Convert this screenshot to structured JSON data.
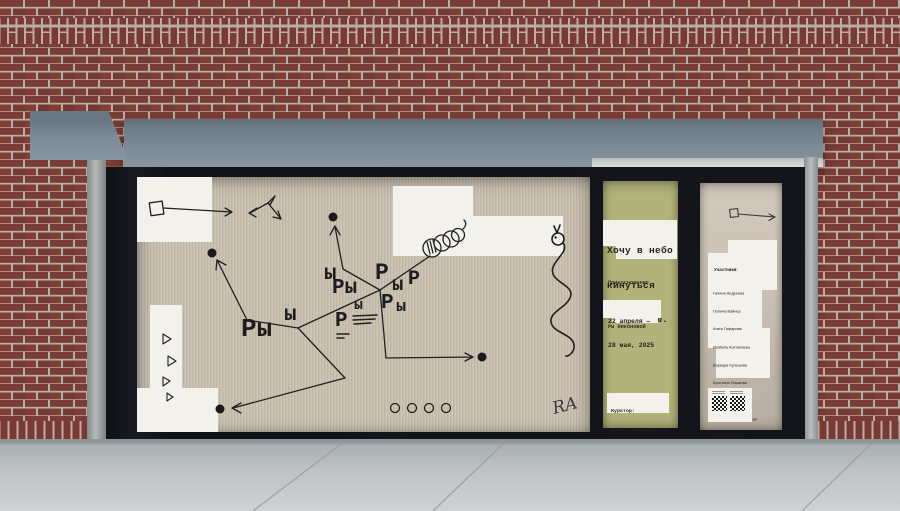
{
  "window_main": {
    "letters": [
      {
        "t": "ы",
        "x": 187,
        "y": 87,
        "s": 21
      },
      {
        "t": "Ры",
        "x": 195,
        "y": 101,
        "s": 21
      },
      {
        "t": "Р",
        "x": 238,
        "y": 85,
        "s": 23
      },
      {
        "t": "ы",
        "x": 255,
        "y": 99,
        "s": 19
      },
      {
        "t": "Р",
        "x": 271,
        "y": 93,
        "s": 20
      },
      {
        "t": "ы",
        "x": 217,
        "y": 121,
        "s": 15
      },
      {
        "t": "Р",
        "x": 244,
        "y": 116,
        "s": 21
      },
      {
        "t": "ы",
        "x": 259,
        "y": 122,
        "s": 17
      },
      {
        "t": "Р",
        "x": 198,
        "y": 134,
        "s": 21
      },
      {
        "t": "ы",
        "x": 147,
        "y": 128,
        "s": 21
      },
      {
        "t": "Ры",
        "x": 104,
        "y": 139,
        "s": 26
      }
    ],
    "signature": "RA"
  },
  "window_left_panel": {
    "title_lines": [
      "Хочу в небо",
      "кинуться",
      "собакою."
    ],
    "subtitle_lines": [
      "Прикосновение",
      "к архиву",
      "Ры Никоновой"
    ],
    "date_lines": [
      "22 апреля —",
      "28 мая, 2025"
    ],
    "curator_lines": [
      "Куратор:",
      "Алёна Герасимчук"
    ]
  },
  "window_right_panel": {
    "participants_label": "Участники:",
    "participants": [
      "Галина Андреева",
      "Полина Вайнер",
      "Агата Гафарова",
      "Изабель Кокталиева",
      "Варвара Кулешова",
      "Кристина Пашкова",
      "Арина Смирнова",
      "Ярослава Трохимовская",
      "Рената Шарипова"
    ]
  },
  "colors": {
    "brick": "#80403a",
    "mortar": "#c6bcaf",
    "awning": "#7b8893",
    "frame": "#14141b",
    "poster_bg": "#c9bfaf",
    "poster_white": "#f3f1ec",
    "panel_green": "#b1b37a",
    "panel_taupe": "#cdc3b7",
    "sidewalk": "#bfc3c4",
    "ink": "#1d1d1d"
  }
}
